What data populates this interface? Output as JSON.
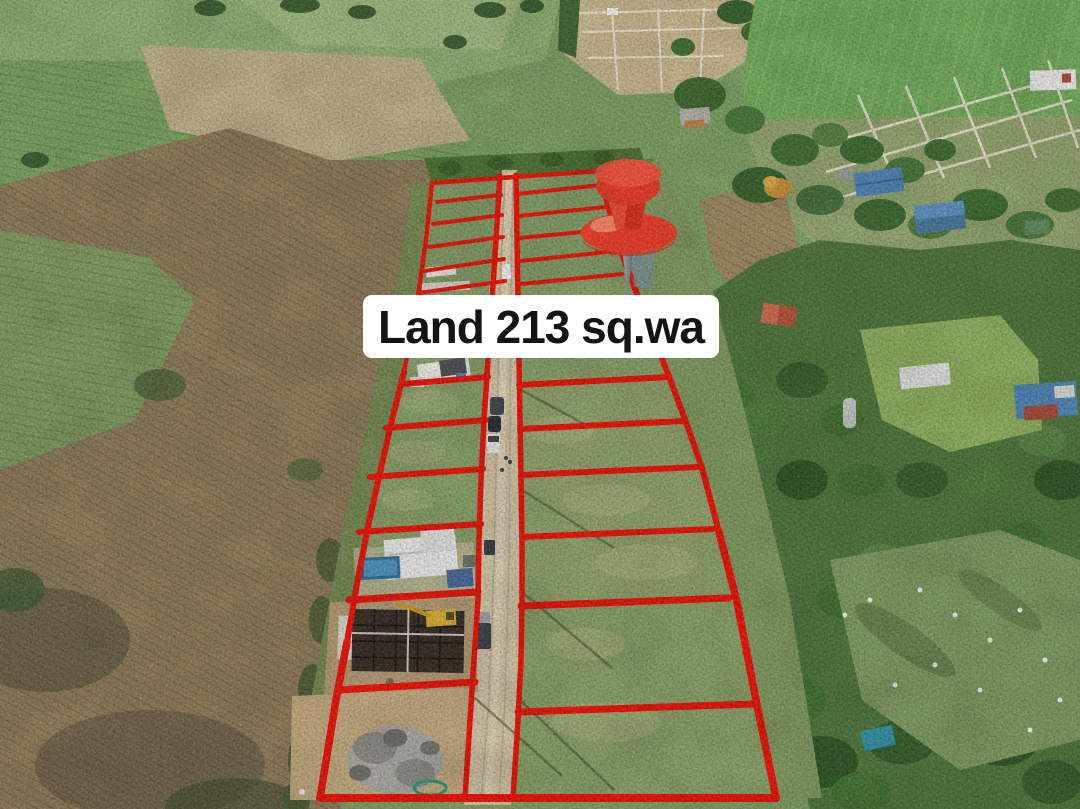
{
  "scene": {
    "type": "aerial-drone-photo",
    "description": "Drone photo of a rural land subdivision: grass plots outlined in red on both sides of a dirt road, dry cornfield on the left, crop fields above, village houses and orchard trees on the right, a construction site and gravel pile in the lower-left plots."
  },
  "overlay": {
    "label": {
      "text": "Land 213 sq.wa"
    },
    "marker": {
      "name": "pushpin",
      "style": "red 3D pushpin"
    }
  },
  "colors": {
    "plot_boundary": "#ee1005",
    "road": "#d2c4a4",
    "label_bg": "#ffffff",
    "label_text": "#141414",
    "pin": "#f03c26",
    "pin_dark": "#d92d18"
  }
}
